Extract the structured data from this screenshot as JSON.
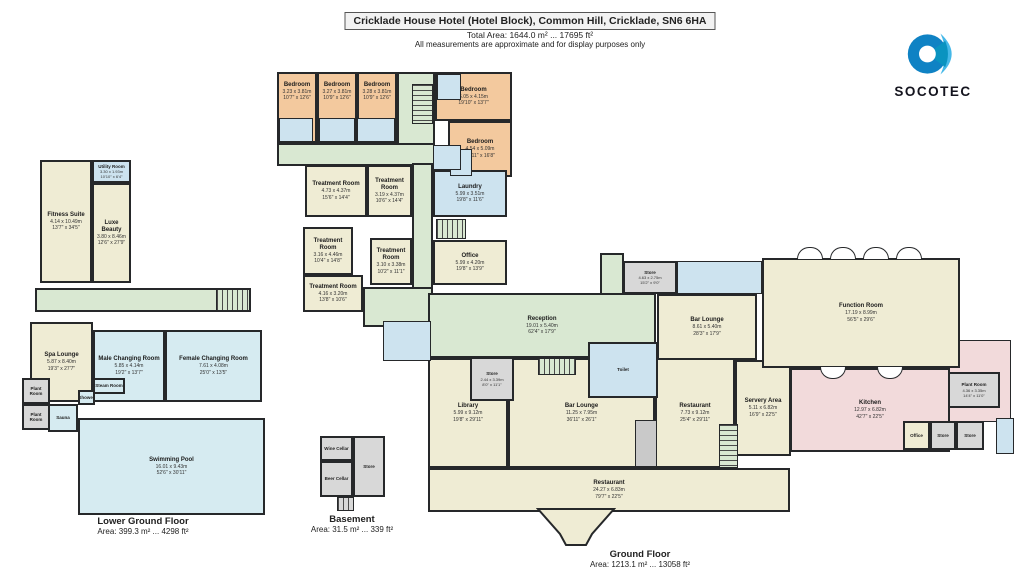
{
  "header": {
    "title": "Cricklade House Hotel (Hotel Block), Common Hill, Cricklade, SN6 6HA",
    "total_area": "Total Area: 1644.0 m² ... 17695 ft²",
    "disclaimer": "All measurements are approximate and for display purposes only"
  },
  "logo": {
    "brand": "SOCOTEC"
  },
  "colors": {
    "bedroom": "#f3c99e",
    "room": "#efecd4",
    "corridor": "#d9e8d2",
    "wet_room": "#cde3ef",
    "pool": "#d6ebf1",
    "store": "#d8d8d8",
    "kitchen": "#f2dadb",
    "wall": "#26282a"
  },
  "floors": {
    "ground": {
      "label": "Ground Floor",
      "area": "Area: 1213.1 m² ... 13058 ft²",
      "rooms": {
        "bed1": {
          "name": "Bedroom",
          "m": "3.23 x 3.81m",
          "ft": "10'7\" x 12'6\""
        },
        "bed2": {
          "name": "Bedroom",
          "m": "3.27 x 3.81m",
          "ft": "10'9\" x 12'6\""
        },
        "bed3": {
          "name": "Bedroom",
          "m": "3.28 x 3.81m",
          "ft": "10'9\" x 12'6\""
        },
        "bed4": {
          "name": "Bedroom",
          "m": "6.05 x 4.15m",
          "ft": "19'10\" x 13'7\""
        },
        "bed5": {
          "name": "Bedroom",
          "m": "4.54 x 5.09m",
          "ft": "14'11\" x 16'8\""
        },
        "tr1": {
          "name": "Treatment Room",
          "m": "4.73 x 4.37m",
          "ft": "15'6\" x 14'4\""
        },
        "tr2": {
          "name": "Treatment Room",
          "m": "3.19 x 4.37m",
          "ft": "10'6\" x 14'4\""
        },
        "laundry": {
          "name": "Laundry",
          "m": "5.99 x 3.51m",
          "ft": "19'8\" x 11'6\""
        },
        "tr3": {
          "name": "Treatment Room",
          "m": "3.16 x 4.46m",
          "ft": "10'4\" x 14'8\""
        },
        "tr4": {
          "name": "Treatment Room",
          "m": "3.10 x 3.38m",
          "ft": "10'2\" x 11'1\""
        },
        "office1": {
          "name": "Office",
          "m": "5.99 x 4.20m",
          "ft": "19'8\" x 13'9\""
        },
        "tr5": {
          "name": "Treatment Room",
          "m": "4.16 x 3.20m",
          "ft": "13'8\" x 10'6\""
        },
        "reception": {
          "name": "Reception",
          "m": "19.01 x 5.40m",
          "ft": "62'4\" x 17'9\""
        },
        "store1": {
          "name": "Store",
          "m": "2.44 x 3.39m",
          "ft": "8'0\" x 11'1\""
        },
        "toilet": {
          "name": "Toilet"
        },
        "store2": {
          "name": "Store",
          "m": "4.63 x 2.75m",
          "ft": "15'2\" x 9'0\""
        },
        "barlounge1": {
          "name": "Bar Lounge",
          "m": "8.61 x 5.40m",
          "ft": "28'3\" x 17'9\""
        },
        "function": {
          "name": "Function Room",
          "m": "17.19 x 8.99m",
          "ft": "56'5\" x 29'6\""
        },
        "library": {
          "name": "Library",
          "m": "5.99 x 9.12m",
          "ft": "19'8\" x 29'11\""
        },
        "barlounge2": {
          "name": "Bar Lounge",
          "m": "11.25 x 7.95m",
          "ft": "36'11\" x 26'1\""
        },
        "restaurant1": {
          "name": "Restaurant",
          "m": "7.73 x 9.12m",
          "ft": "25'4\" x 29'11\""
        },
        "servery": {
          "name": "Servery Area",
          "m": "5.11 x 6.82m",
          "ft": "16'9\" x 22'5\""
        },
        "restaurant2": {
          "name": "Restaurant",
          "m": "24.27 x 6.83m",
          "ft": "79'7\" x 22'5\""
        },
        "kitchen": {
          "name": "Kitchen",
          "m": "12.97 x 6.82m",
          "ft": "42'7\" x 22'5\""
        },
        "plant": {
          "name": "Plant Room",
          "m": "4.36 x 3.35m",
          "ft": "14'4\" x 11'0\""
        },
        "office2": {
          "name": "Office"
        },
        "store3": {
          "name": "Store"
        },
        "store4": {
          "name": "Store"
        }
      }
    },
    "lower_ground": {
      "label": "Lower Ground Floor",
      "area": "Area: 399.3 m² ... 4298 ft²",
      "rooms": {
        "utility": {
          "name": "Utility Room",
          "m": "3.30 x 1.93m",
          "ft": "10'10\" x 6'4\""
        },
        "fitness": {
          "name": "Fitness Suite",
          "m": "4.14 x 10.49m",
          "ft": "13'7\" x 34'5\""
        },
        "luxe": {
          "name": "Luxe Beauty",
          "m": "3.80 x 8.46m",
          "ft": "12'6\" x 27'9\""
        },
        "spa": {
          "name": "Spa Lounge",
          "m": "5.87 x 8.40m",
          "ft": "19'3\" x 27'7\""
        },
        "male": {
          "name": "Male Changing Room",
          "m": "5.85 x 4.14m",
          "ft": "19'2\" x 13'7\""
        },
        "female": {
          "name": "Female Changing Room",
          "m": "7.61 x 4.08m",
          "ft": "25'0\" x 13'5\""
        },
        "plant1": {
          "name": "Plant Room"
        },
        "plant2": {
          "name": "Plant Room"
        },
        "sauna": {
          "name": "Sauna"
        },
        "shower": {
          "name": "Shower"
        },
        "steam": {
          "name": "Steam Room"
        },
        "pool": {
          "name": "Swimming Pool",
          "m": "16.01 x 9.43m",
          "ft": "52'6\" x 30'11\""
        }
      }
    },
    "basement": {
      "label": "Basement",
      "area": "Area: 31.5 m² ... 339 ft²",
      "rooms": {
        "wine": {
          "name": "Wine Cellar"
        },
        "beer": {
          "name": "Beer Cellar"
        },
        "bstore": {
          "name": "Store"
        }
      }
    }
  }
}
